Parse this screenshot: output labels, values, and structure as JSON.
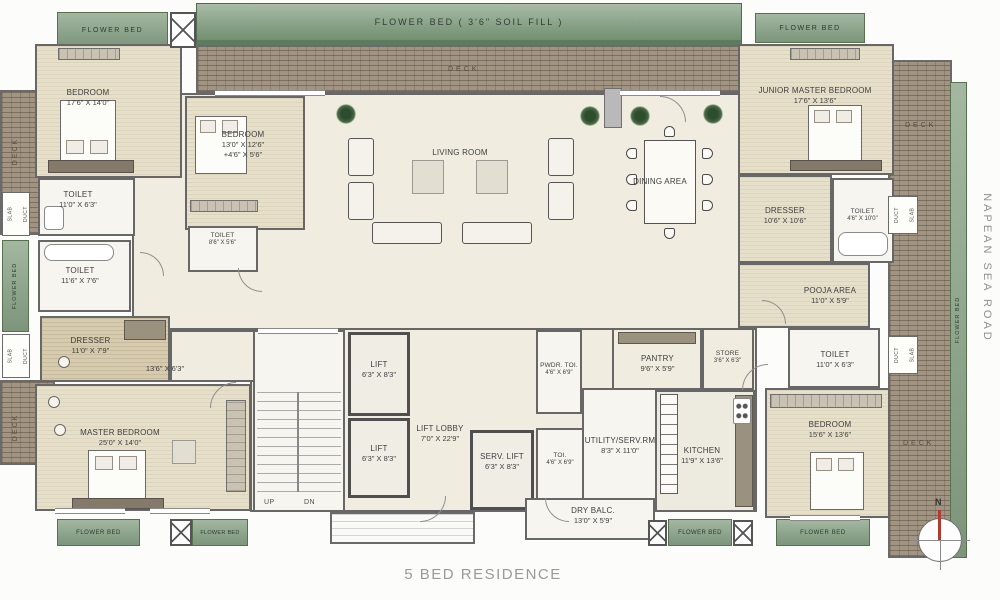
{
  "title": "5 BED RESIDENCE",
  "road": {
    "name": "NAPEAN SEA ROAD"
  },
  "compass": {
    "north": "N"
  },
  "beds_strips": {
    "top_main": "FLOWER BED ( 3'6\" SOIL FILL )",
    "flower_bed": "FLOWER BED"
  },
  "deck": {
    "label": "DECK"
  },
  "shafts": {
    "slab": "SLAB",
    "duct": "DUCT"
  },
  "stairs": {
    "up": "UP",
    "dn": "DN"
  },
  "rooms": {
    "bedroom1": {
      "name": "BEDROOM",
      "dims": "17'6\" X 14'0\""
    },
    "bedroom2": {
      "name": "BEDROOM",
      "dims": "13'0\" X 12'6\"",
      "dims2": "+4'6\" X 5'6\""
    },
    "toilet1": {
      "name": "TOILET",
      "dims": "11'0\" X 6'3\""
    },
    "toilet2": {
      "name": "TOILET",
      "dims": "11'6\" X 7'6\""
    },
    "toilet3": {
      "name": "TOILET",
      "dims": "8'6\" X 5'6\""
    },
    "dresser_left": {
      "name": "DRESSER",
      "dims": "11'0\" X 7'9\""
    },
    "passage": {
      "dims": "13'6\" X 6'3\""
    },
    "master": {
      "name": "MASTER BEDROOM",
      "dims": "25'0\" X 14'0\""
    },
    "living": {
      "name": "LIVING ROOM"
    },
    "dining": {
      "name": "DINING AREA"
    },
    "lift1": {
      "name": "LIFT",
      "dims": "6'3\" X 8'3\""
    },
    "lift2": {
      "name": "LIFT",
      "dims": "6'3\" X 8'3\""
    },
    "lift_lobby": {
      "name": "LIFT LOBBY",
      "dims": "7'0\" X 22'9\""
    },
    "serv_lift": {
      "name": "SERV. LIFT",
      "dims": "6'3\" X 8'3\""
    },
    "pwdr_toi": {
      "name": "PWDR. TOI.",
      "dims": "4'6\" X 6'9\""
    },
    "toi": {
      "name": "TOI.",
      "dims": "4'6\" X 6'9\""
    },
    "utility": {
      "name": "UTILITY/SERV.RM",
      "dims": "8'3\" X 11'0\""
    },
    "pantry": {
      "name": "PANTRY",
      "dims": "9'6\" X 5'9\""
    },
    "store": {
      "name": "STORE",
      "dims": "3'6\" X 6'3\""
    },
    "kitchen": {
      "name": "KITCHEN",
      "dims": "11'9\" X 13'6\""
    },
    "dry_balc": {
      "name": "DRY BALC.",
      "dims": "13'0\" X 5'9\""
    },
    "pooja": {
      "name": "POOJA AREA",
      "dims": "11'0\" X 5'9\""
    },
    "toilet_r": {
      "name": "TOILET",
      "dims": "11'0\" X 6'3\""
    },
    "bedroom5": {
      "name": "BEDROOM",
      "dims": "15'6\" X 13'6\""
    },
    "dresser_right": {
      "name": "DRESSER",
      "dims": "10'6\" X 10'6\""
    },
    "toilet_jr": {
      "name": "TOILET",
      "dims": "4'6\" X 10'0\""
    },
    "junior_master": {
      "name": "JUNIOR MASTER BEDROOM",
      "dims": "17'6\" X 13'6\""
    }
  }
}
